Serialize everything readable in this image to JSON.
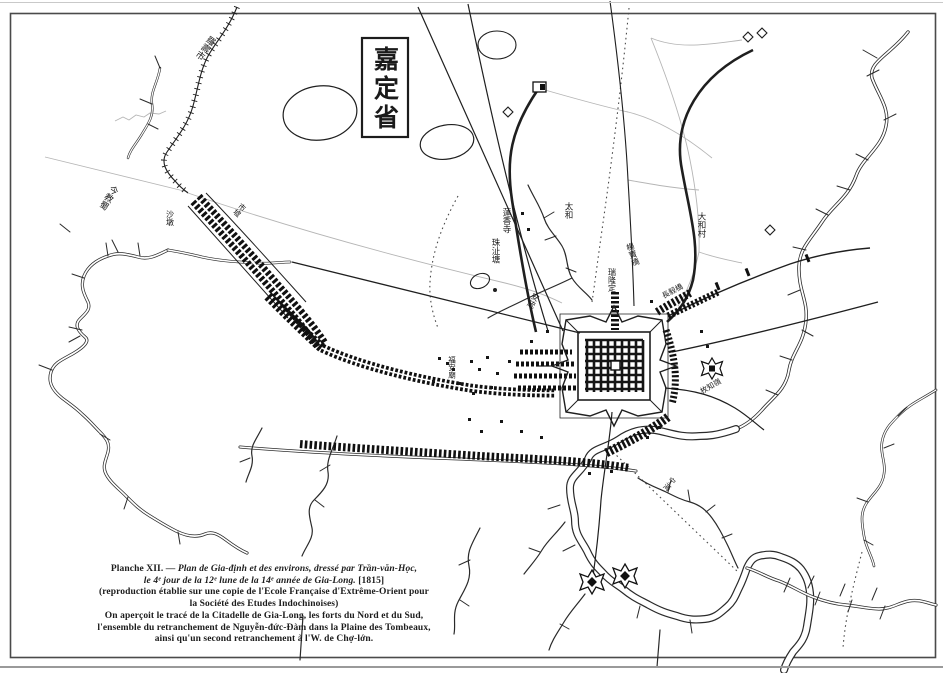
{
  "page": {
    "paper_color": "#ffffff",
    "ink_color": "#1f1f1f",
    "frame_color": "#4a4a4a",
    "faint_line_color": "#b5b5b5"
  },
  "title_box": {
    "text": "嘉定省"
  },
  "caption": {
    "line1_prefix": "Planche XII. —",
    "line1_italic": "Plan de Gia-định et des environs, dressé par Trần-văn-Học,",
    "line2_italic": "le 4ᵉ jour de la 12ᵉ lune de la 14ᵉ année de Gia-Long.",
    "line2_suffix": "[1815]",
    "line3": "(reproduction établie sur une copie de l'Ecole Française d'Extrême-Orient pour",
    "line4": "la Société des Etudes Indochinoises)",
    "line5": "On aperçoit le tracé de la Citadelle de Gia-Long, les forts du Nord et du Sud,",
    "line6": "l'ensemble du retranchement de Nguyễn-đức-Đàm dans la Plaine des Tombeaux,",
    "line7": "ainsi qu'un second  retranchement à l'W. de Chợ-lớn."
  },
  "labels": [
    {
      "text": "羅壽市"
    },
    {
      "text": "今教蜀"
    },
    {
      "text": "沙墩"
    },
    {
      "text": "蓮香寺"
    },
    {
      "text": "太和"
    },
    {
      "text": "珠沚塘"
    },
    {
      "text": "安統"
    },
    {
      "text": "瑞隆定"
    },
    {
      "text": "楊寶橋"
    },
    {
      "text": "大和村"
    },
    {
      "text": "長毅橋"
    },
    {
      "text": "枚知嶺"
    },
    {
      "text": "宁海"
    },
    {
      "text": "福安廟"
    },
    {
      "text": "市墟"
    }
  ]
}
